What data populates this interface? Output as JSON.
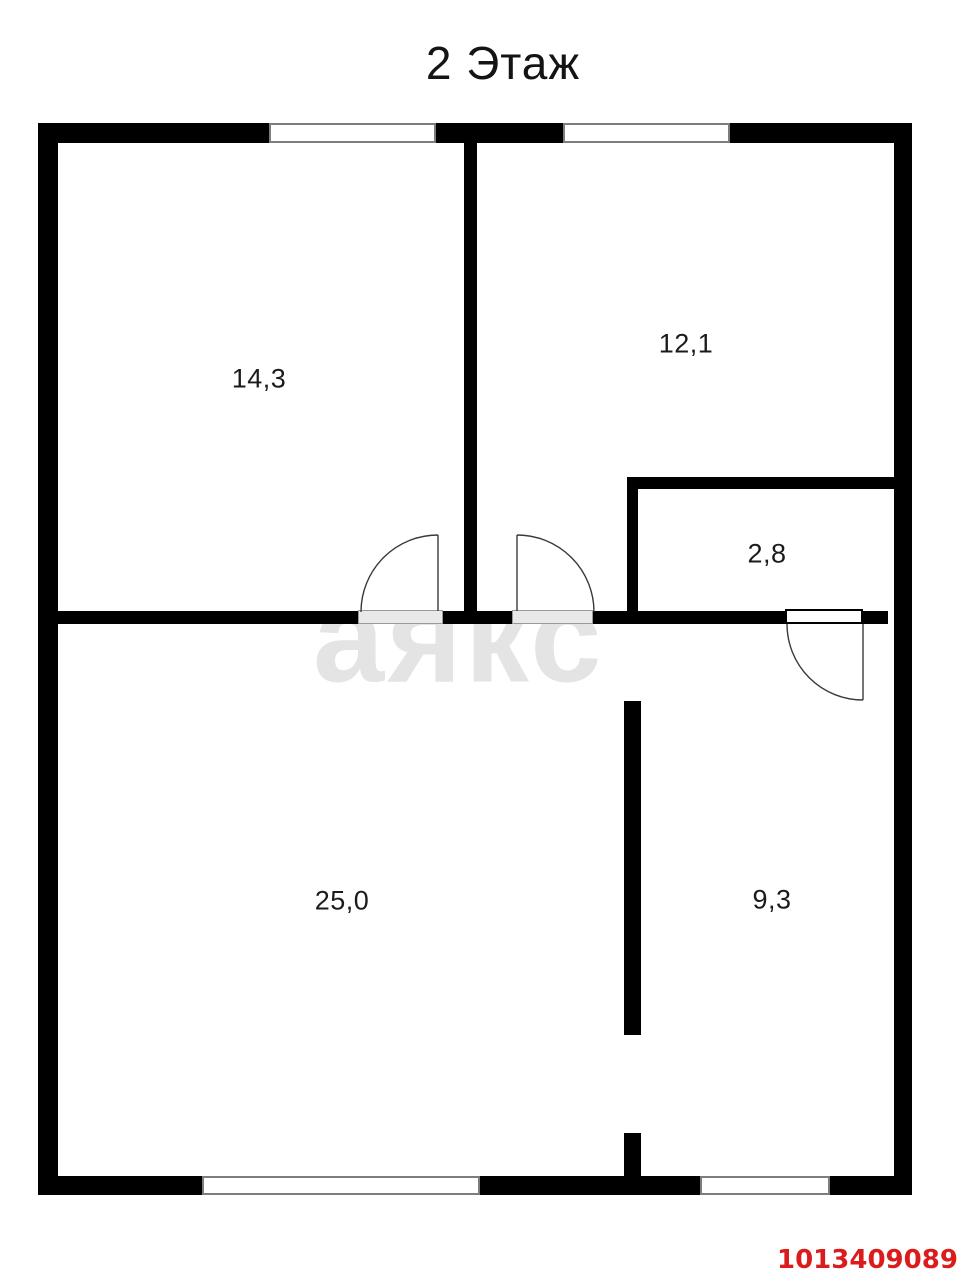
{
  "title": "2 Этаж",
  "watermark": "аякс",
  "listing_id": "1013409089",
  "rooms": [
    {
      "name": "room-top-left",
      "area": "14,3"
    },
    {
      "name": "room-top-right",
      "area": "12,1"
    },
    {
      "name": "room-closet",
      "area": "2,8"
    },
    {
      "name": "room-bottom-left",
      "area": "25,0"
    },
    {
      "name": "room-bottom-right",
      "area": "9,3"
    }
  ],
  "colors": {
    "wall": "#000000",
    "watermark_gray": "#e4e4e4",
    "door_opening_gray": "#e9e9e9",
    "listing_id_red": "#dc1c1c",
    "background": "#ffffff"
  }
}
